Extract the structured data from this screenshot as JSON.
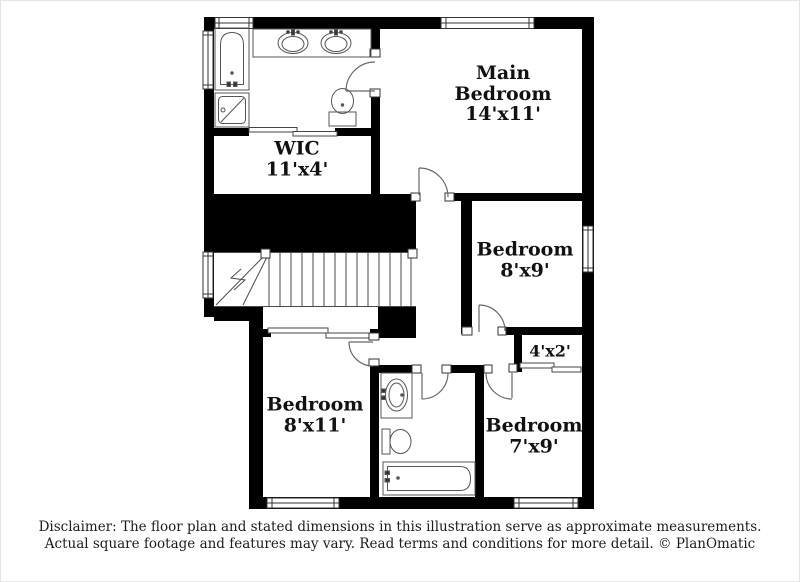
{
  "plan": {
    "rooms": {
      "main_bedroom": {
        "line1": "Main",
        "line2": "Bedroom",
        "dims": "14'x11'"
      },
      "wic": {
        "line1": "WIC",
        "dims": "11'x4'"
      },
      "bedroom_8x9": {
        "line1": "Bedroom",
        "dims": "8'x9'"
      },
      "bedroom_8x11": {
        "line1": "Bedroom",
        "dims": "8'x11'"
      },
      "bedroom_7x9": {
        "line1": "Bedroom",
        "dims": "7'x9'"
      },
      "closet": {
        "dims": "4'x2'"
      }
    },
    "fixture_icons": [
      "bathtub-icon",
      "shower-icon",
      "double-sink-vanity-icon",
      "toilet-icon",
      "sink-vanity-icon",
      "toilet-icon",
      "bathtub-icon",
      "staircase-icon",
      "door-arc-icon",
      "window-icon",
      "sliding-door-icon"
    ],
    "colors": {
      "wall": "#000000",
      "line": "#4a4a4a",
      "text": "#111111",
      "background": "#ffffff"
    }
  },
  "disclaimer": {
    "line1": "Disclaimer: The floor plan and stated dimensions in this illustration serve as approximate measurements.",
    "line2": "Actual square footage and features may vary. Read terms and conditions for more detail. © PlanOmatic"
  }
}
